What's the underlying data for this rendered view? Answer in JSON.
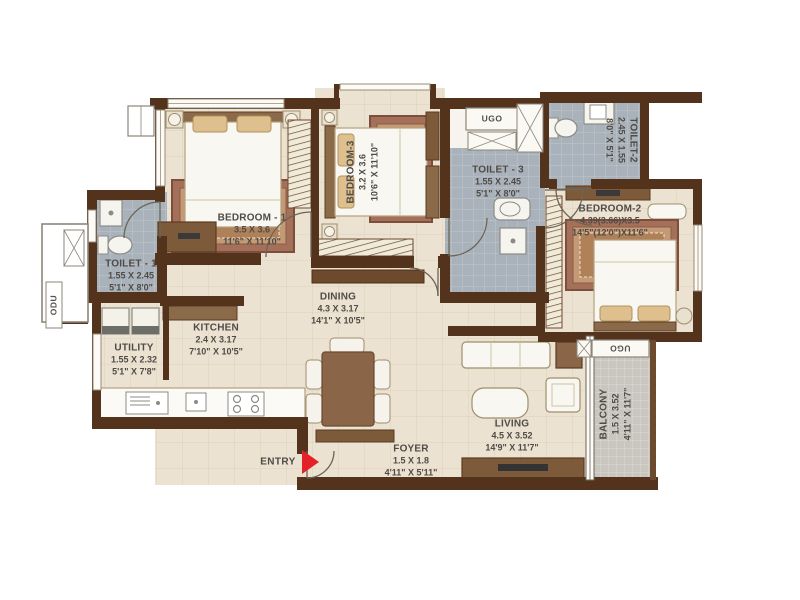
{
  "colors": {
    "wall": "#53331b",
    "floor_beige": "#ece2d1",
    "toilet_floor": "#a9b2ba",
    "balcony_floor": "#c8c6bf",
    "wood": "#7d5a3a",
    "accent_red": "#e32128",
    "label_text": "#4f4b47"
  },
  "entry": {
    "label": "ENTRY"
  },
  "ducts": {
    "ugo_top": "UGO",
    "ugo_balcony": "UGO",
    "odu": "ODU"
  },
  "rooms": {
    "bedroom1": {
      "name": "BEDROOM - 1",
      "dim_m": "3.5 X 3.6",
      "dim_ft": "11'6\" X 11'10\""
    },
    "bedroom3": {
      "name": "BEDROOM-3",
      "dim_m": "3.2 X 3.6",
      "dim_ft": "10'6\" X 11'10\""
    },
    "bedroom2": {
      "name": "BEDROOM-2",
      "dim_m": "4.39(3.66)X3.5",
      "dim_ft": "14'5\"(12'0\")X11'6\""
    },
    "toilet1": {
      "name": "TOILET - 1",
      "dim_m": "1.55 X 2.45",
      "dim_ft": "5'1\" X 8'0\""
    },
    "toilet2": {
      "name": "TOILET-2",
      "dim_m": "2.45 X 1.55",
      "dim_ft": "8'0\" X 5'1\""
    },
    "toilet3": {
      "name": "TOILET - 3",
      "dim_m": "1.55 X 2.45",
      "dim_ft": "5'1\" X 8'0\""
    },
    "utility": {
      "name": "UTILITY",
      "dim_m": "1.55 X 2.32",
      "dim_ft": "5'1\" X 7'8\""
    },
    "kitchen": {
      "name": "KITCHEN",
      "dim_m": "2.4 X 3.17",
      "dim_ft": "7'10\" X 10'5\""
    },
    "dining": {
      "name": "DINING",
      "dim_m": "4.3 X 3.17",
      "dim_ft": "14'1\" X 10'5\""
    },
    "living": {
      "name": "LIVING",
      "dim_m": "4.5 X 3.52",
      "dim_ft": "14'9\" X 11'7\""
    },
    "balcony": {
      "name": "BALCONY",
      "dim_m": "1.5 X 3.52",
      "dim_ft": "4'11\" X 11'7\""
    },
    "foyer": {
      "name": "FOYER",
      "dim_m": "1.5 X 1.8",
      "dim_ft": "4'11\" X 5'11\""
    }
  }
}
